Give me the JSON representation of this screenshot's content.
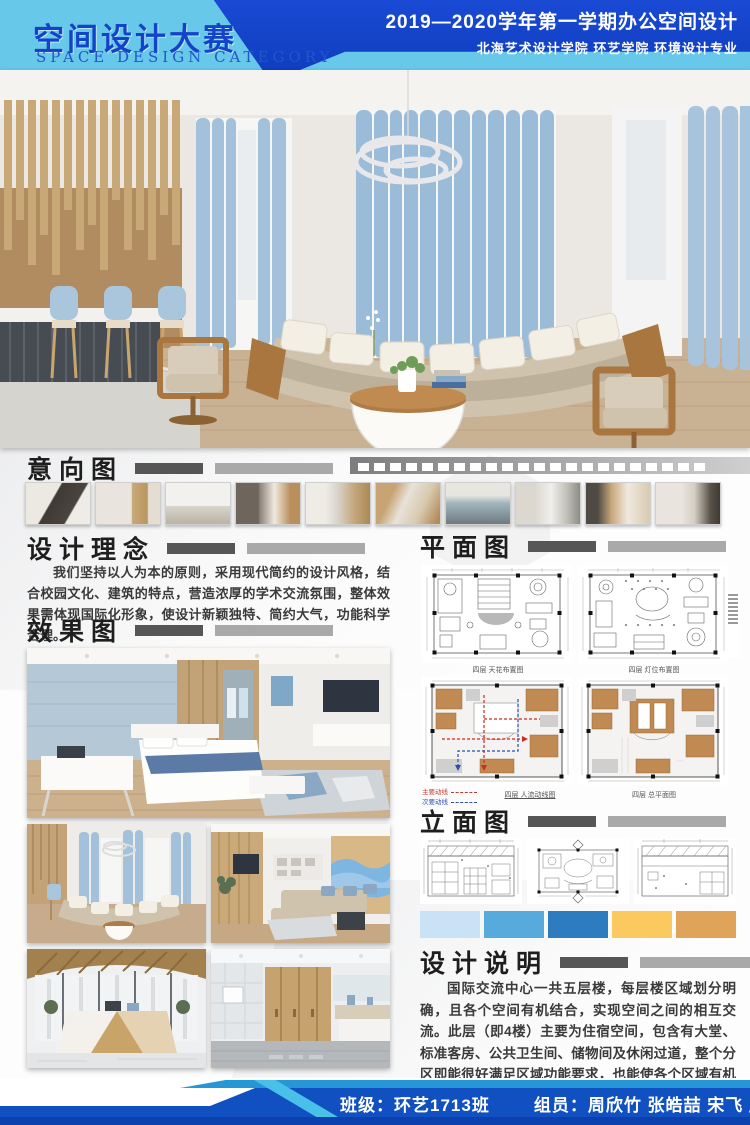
{
  "header": {
    "title_cn": "空间设计大赛",
    "title_en": "SPACE DESIGN CATEGORY",
    "term_title": "2019—2020学年第一学期办公空间设计",
    "school_line": "北海艺术设计学院  环艺学院  环境设计专业"
  },
  "sections": {
    "intent": {
      "title": "意向图"
    },
    "concept": {
      "title": "设计理念",
      "body": "我们坚持以人为本的原则，采用现代简约的设计风格，结合校园文化、建筑的特点，营造浓厚的学术交流氛围，整体效果需体现国际化形象，使设计新颖独特、简约大气，功能科学合理。"
    },
    "renders": {
      "title": "效果图"
    },
    "plans": {
      "title": "平面图",
      "captions": [
        "四层 天花布置图",
        "四层 灯位布置图",
        "四层 人流动线图",
        "四层 总平面图"
      ],
      "legend": [
        {
          "label": "主要动线",
          "color": "#c43a2f"
        },
        {
          "label": "次要动线",
          "color": "#2a4fae"
        }
      ]
    },
    "elevations": {
      "title": "立面图",
      "captions": [
        "A 立面图",
        "立面索引图",
        "B 立面图"
      ],
      "palette": [
        "#c9e2f6",
        "#56abdc",
        "#2e7cc0",
        "#fcc95e",
        "#dfa45a"
      ]
    },
    "description": {
      "title": "设计说明",
      "body": "国际交流中心一共五层楼，每层楼区域划分明确，且各个空间有机结合，实现空间之间的相互交流。此层（即4楼）主要为住宿空间，包含有大堂、标准客房、公共卫生间、储物间及休闲过道，整个分区即能很好满足区域功能要求，也能使各个区域有机结合。设计以现代简约风格为主，色调主要为原木色、白色、灰色，加蓝色为点缀，营造出使人身心放松、舒适愉悦的休息氛围。"
    }
  },
  "footer": {
    "class_label": "班级：环艺1713班",
    "members_label": "组员：周欣竹  张皓喆  宋飞  唐羽"
  },
  "colors": {
    "header_light": "#67c8ea",
    "header_dark": "#1446cc",
    "footer_blue": "#1150c0"
  }
}
